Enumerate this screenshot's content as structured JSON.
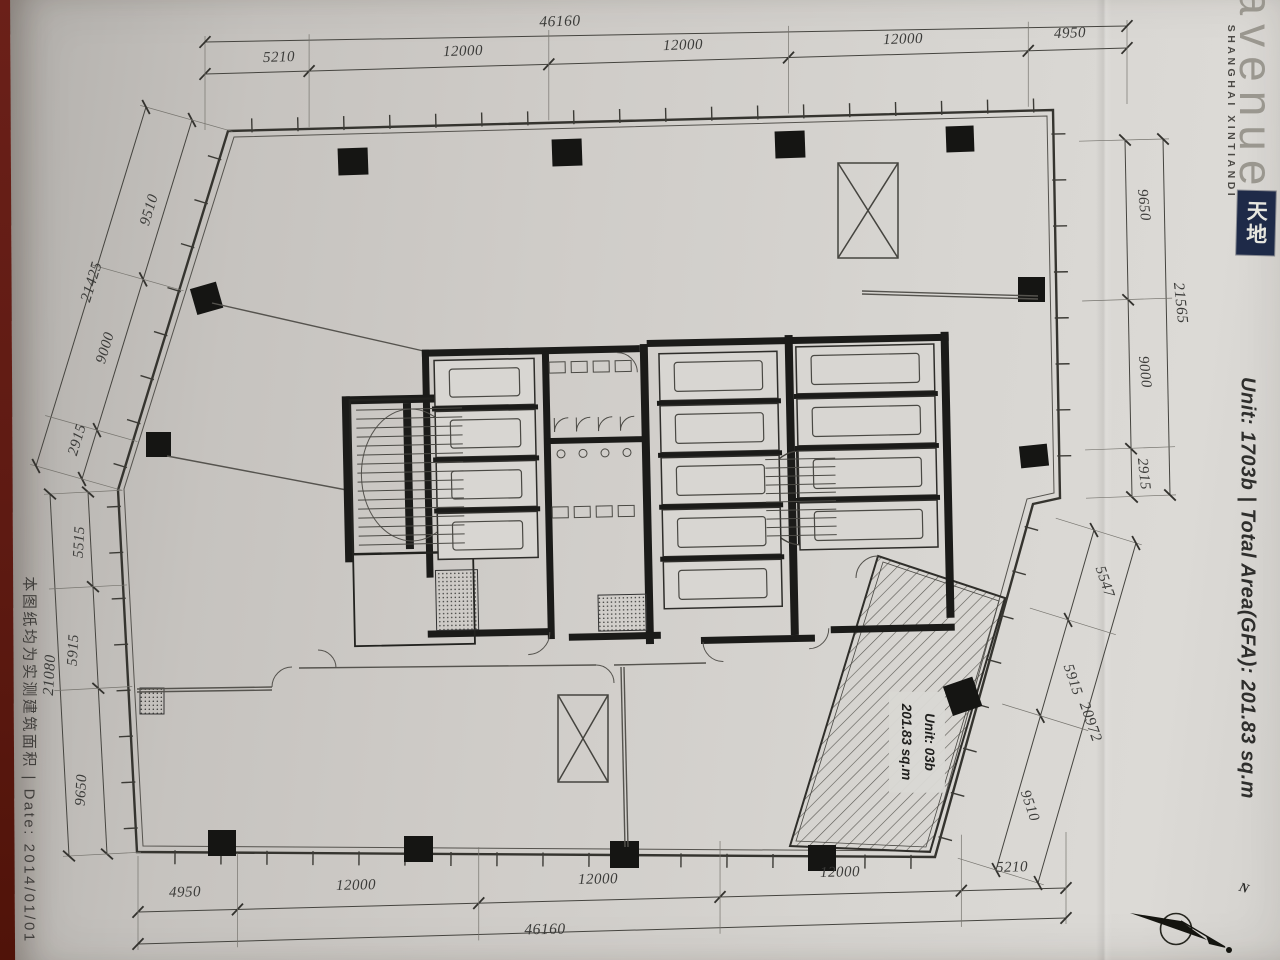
{
  "branding": {
    "logo_text": "avenue",
    "logo_subtext": "SHANGHAI XINTIANDI",
    "logo_mark": "天地",
    "logo_mark_color": "#1e2a48"
  },
  "title": {
    "unit_title": "Unit: 1703b | Total Area(GFA): 201.83 sq.m"
  },
  "side_note": {
    "text": "本图纸均为实测建筑面积  |  Date: 2014/01/01"
  },
  "unit_label": {
    "line1": "Unit: 03b",
    "line2": "201.83 sq.m"
  },
  "north": {
    "label": "N"
  },
  "dims": {
    "top": {
      "total": "46160",
      "segments": [
        "5210",
        "12000",
        "12000",
        "12000",
        "4950"
      ]
    },
    "bottom": {
      "total": "46160",
      "segments": [
        "4950",
        "12000",
        "12000",
        "12000",
        "5210"
      ]
    },
    "left_upper": {
      "total": "21425",
      "segments": [
        "9510",
        "9000",
        "2915"
      ]
    },
    "left_lower": {
      "total": "21080",
      "segments": [
        "5515",
        "5915",
        "9650"
      ]
    },
    "right_upper": {
      "total": "21565",
      "segments": [
        "9650",
        "9000",
        "2915"
      ]
    },
    "right_lower": {
      "total": "20972",
      "segments": [
        "5547",
        "5915",
        "9510"
      ]
    }
  },
  "colors": {
    "table_red": "#5e1a12",
    "paper_grey": "#d2d0cc",
    "ink": "#3b3b39"
  }
}
